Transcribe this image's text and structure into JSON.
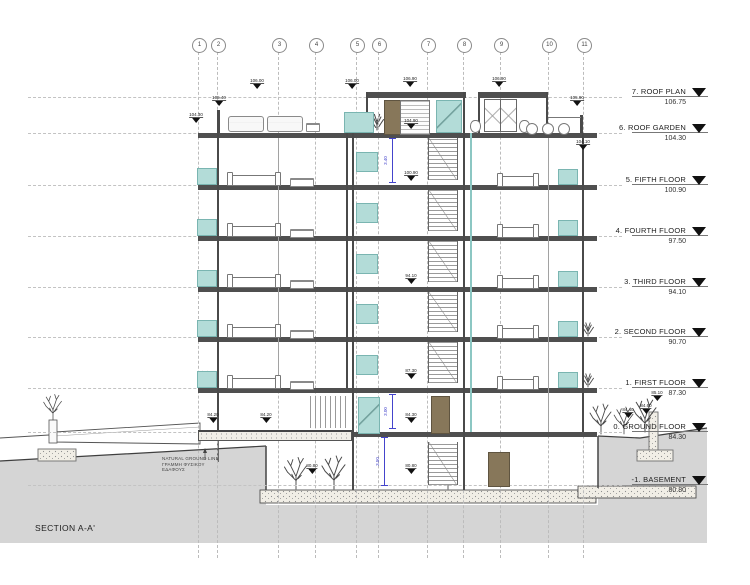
{
  "drawing": {
    "section_label": "SECTION A-A'"
  },
  "grid_bubbles": [
    {
      "label": "1",
      "x": 198
    },
    {
      "label": "2",
      "x": 217
    },
    {
      "label": "3",
      "x": 278
    },
    {
      "label": "4",
      "x": 315
    },
    {
      "label": "5",
      "x": 356
    },
    {
      "label": "6",
      "x": 378
    },
    {
      "label": "7",
      "x": 427
    },
    {
      "label": "8",
      "x": 463
    },
    {
      "label": "9",
      "x": 500
    },
    {
      "label": "10",
      "x": 548
    },
    {
      "label": "11",
      "x": 583
    }
  ],
  "levels": [
    {
      "name": "7. ROOF PLAN",
      "elevation": "106.75",
      "y": 97
    },
    {
      "name": "6. ROOF GARDEN",
      "elevation": "104.30",
      "y": 133
    },
    {
      "name": "5. FIFTH FLOOR",
      "elevation": "100.90",
      "y": 185
    },
    {
      "name": "4. FOURTH FLOOR",
      "elevation": "97.50",
      "y": 236
    },
    {
      "name": "3. THIRD FLOOR",
      "elevation": "94.10",
      "y": 287
    },
    {
      "name": "2. SECOND FLOOR",
      "elevation": "90.70",
      "y": 337
    },
    {
      "name": "1. FIRST FLOOR",
      "elevation": "87.30",
      "y": 388
    },
    {
      "name": "0. GROUND FLOOR",
      "elevation": "84.30",
      "y": 432
    },
    {
      "name": "-1. BASEMENT",
      "elevation": "80.80",
      "y": 485
    }
  ],
  "ground_note": {
    "line1": "NATURAL GROUND LINE",
    "line2": "ΓΡΑΜΜΗ ΦΥΣΙΚΟΥ",
    "line3": "ΕΔΑΦΟΥΣ"
  },
  "spot_elevations": [
    {
      "x": 257,
      "y": 84,
      "value": "106.00"
    },
    {
      "x": 352,
      "y": 84,
      "value": "106.00"
    },
    {
      "x": 410,
      "y": 82,
      "value": "106.90"
    },
    {
      "x": 499,
      "y": 82,
      "value": "106.90"
    },
    {
      "x": 577,
      "y": 101,
      "value": "105.90"
    },
    {
      "x": 219,
      "y": 101,
      "value": "105.40"
    },
    {
      "x": 196,
      "y": 118,
      "value": "104.30"
    },
    {
      "x": 583,
      "y": 145,
      "value": "104.10"
    },
    {
      "x": 411,
      "y": 124,
      "value": "104.90"
    },
    {
      "x": 411,
      "y": 176,
      "value": "100.90"
    },
    {
      "x": 411,
      "y": 279,
      "value": "94.10"
    },
    {
      "x": 411,
      "y": 374,
      "value": "87.30"
    },
    {
      "x": 411,
      "y": 418,
      "value": "84.30"
    },
    {
      "x": 411,
      "y": 469,
      "value": "80.80"
    },
    {
      "x": 213,
      "y": 418,
      "value": "84.20"
    },
    {
      "x": 266,
      "y": 418,
      "value": "84.20"
    },
    {
      "x": 312,
      "y": 469,
      "value": "80.80"
    },
    {
      "x": 628,
      "y": 413,
      "value": "84.40"
    },
    {
      "x": 646,
      "y": 409,
      "value": "84.60"
    },
    {
      "x": 657,
      "y": 396,
      "value": "85.10"
    }
  ],
  "dimensions": [
    {
      "x": 392,
      "y1": 138,
      "y2": 183,
      "value": "3.40"
    },
    {
      "x": 392,
      "y1": 394,
      "y2": 429,
      "value": "3.00"
    },
    {
      "x": 384,
      "y1": 437,
      "y2": 486,
      "value": "3.50"
    }
  ],
  "colors": {
    "glazing_teal": "#b3dcd8",
    "door_brown": "#87775a",
    "ground_gray": "#d5d5d5",
    "dimension_blue": "#4444cc",
    "slab_dark": "#4f4f4f"
  }
}
